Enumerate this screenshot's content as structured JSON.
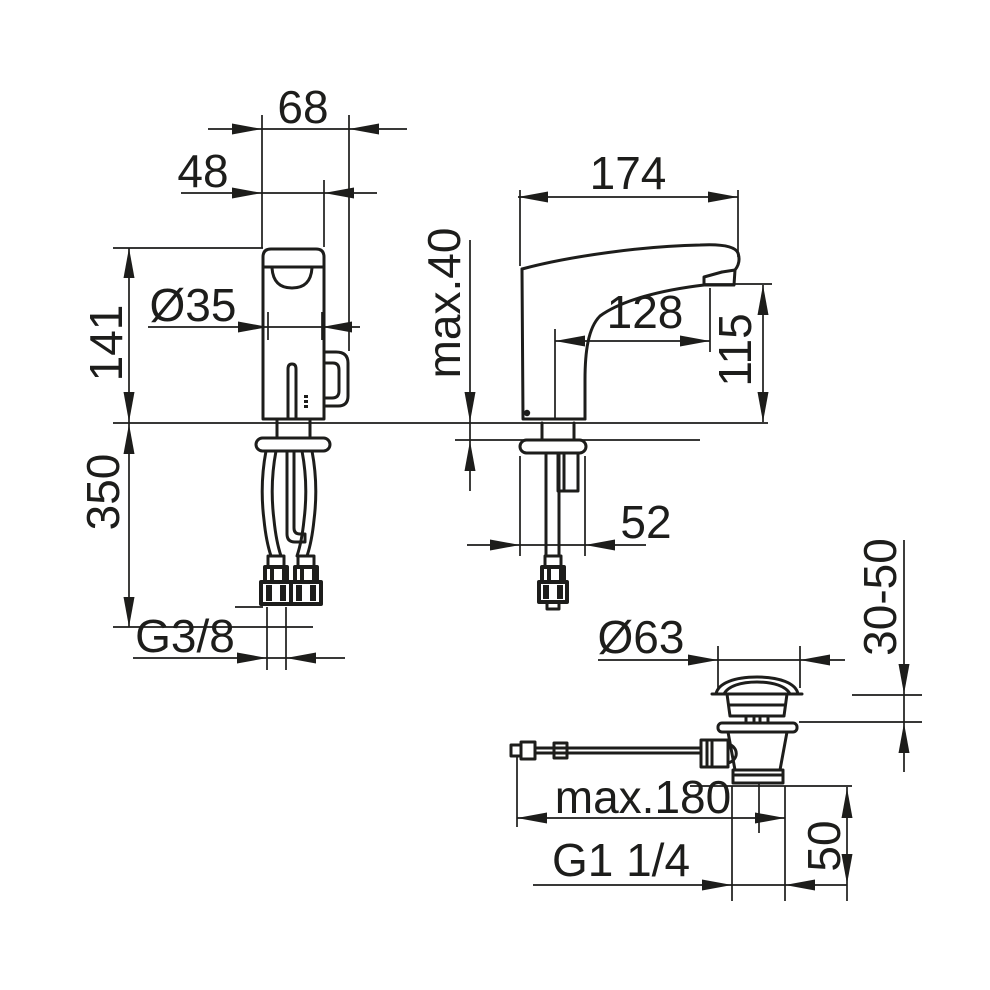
{
  "colors": {
    "background": "#ffffff",
    "line": "#1d1d1b"
  },
  "labels": {
    "dim68": "68",
    "dim48": "48",
    "dia35": "Ø35",
    "dim141": "141",
    "dim350": "350",
    "thread_supply": "G3/8",
    "dim174": "174",
    "max40": "max.40",
    "dim128": "128",
    "dim115": "115",
    "dim52": "52",
    "dia63": "Ø63",
    "range3050": "30-50",
    "max180": "max.180",
    "thread_waste": "G1 1/4",
    "dim50": "50"
  },
  "views": {
    "faucet_front_view": {
      "dimension_labels": [
        "68",
        "48",
        "Ø35",
        "141",
        "350",
        "G3/8"
      ]
    },
    "faucet_side_view": {
      "dimension_labels": [
        "174",
        "max.40",
        "128",
        "115",
        "52"
      ]
    },
    "drain_waste_view": {
      "dimension_labels": [
        "Ø63",
        "30-50",
        "max.180",
        "G1 1/4",
        "50"
      ]
    }
  }
}
